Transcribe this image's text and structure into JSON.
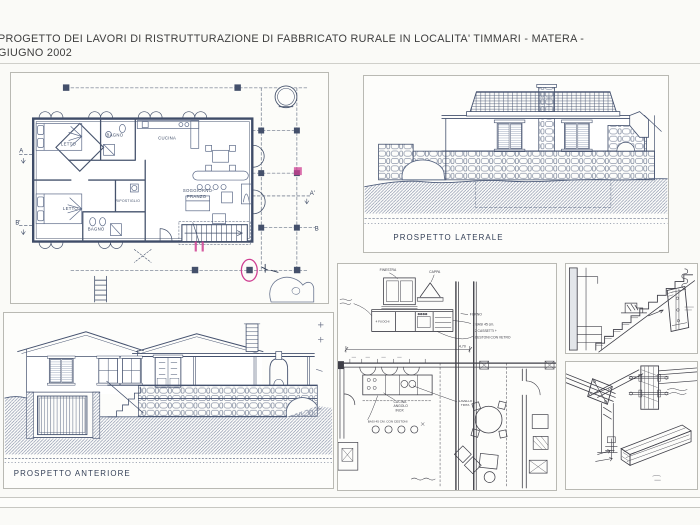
{
  "title": {
    "line1": "PROGETTO DEI LAVORI DI RISTRUTTURAZIONE DI FABBRICATO RURALE IN LOCALITA' TIMMARI - MATERA -",
    "line2": "GIUGNO 2002"
  },
  "colors": {
    "ink": "#46536d",
    "pencil": "#3f3f48",
    "highlight": "#cf3f92",
    "paper": "#fafaf7"
  },
  "floor_plan": {
    "letto1": "LETTO",
    "bagno1": "BAGNO",
    "cucina": "CUCINA",
    "letto2": "LETTO",
    "bagno2": "BAGNO",
    "ripostiglio": "RIPOSTIGLIO",
    "soggiorno1": "SOGGIORNO-",
    "soggiorno2": "PRANZO",
    "sec_a": "A",
    "sec_a1": "A'",
    "sec_b": "B",
    "sec_b1": "B'"
  },
  "elevations": {
    "lateral": "PROSPETTO LATERALE",
    "front": "PROSPETTO ANTERIORE"
  },
  "kitchen_sketch": {
    "finestra": "FINESTRA",
    "cappa": "CAPPA",
    "fuochi": "4 FUOCHI",
    "forno": "FORNO",
    "note1": "2 BASI 45 cm.",
    "note2": "2 CASSETTI +",
    "note3": "CESTONI CON VETRO",
    "cucina1": "CUCINA",
    "cucina2": "ANGOLO",
    "cucina3": "INOX",
    "base_note": "BASI 45 CM. CON CESTONI",
    "lavello1": "LAVELLO +",
    "lavello2": "TRITA",
    "dim": "4,70"
  }
}
